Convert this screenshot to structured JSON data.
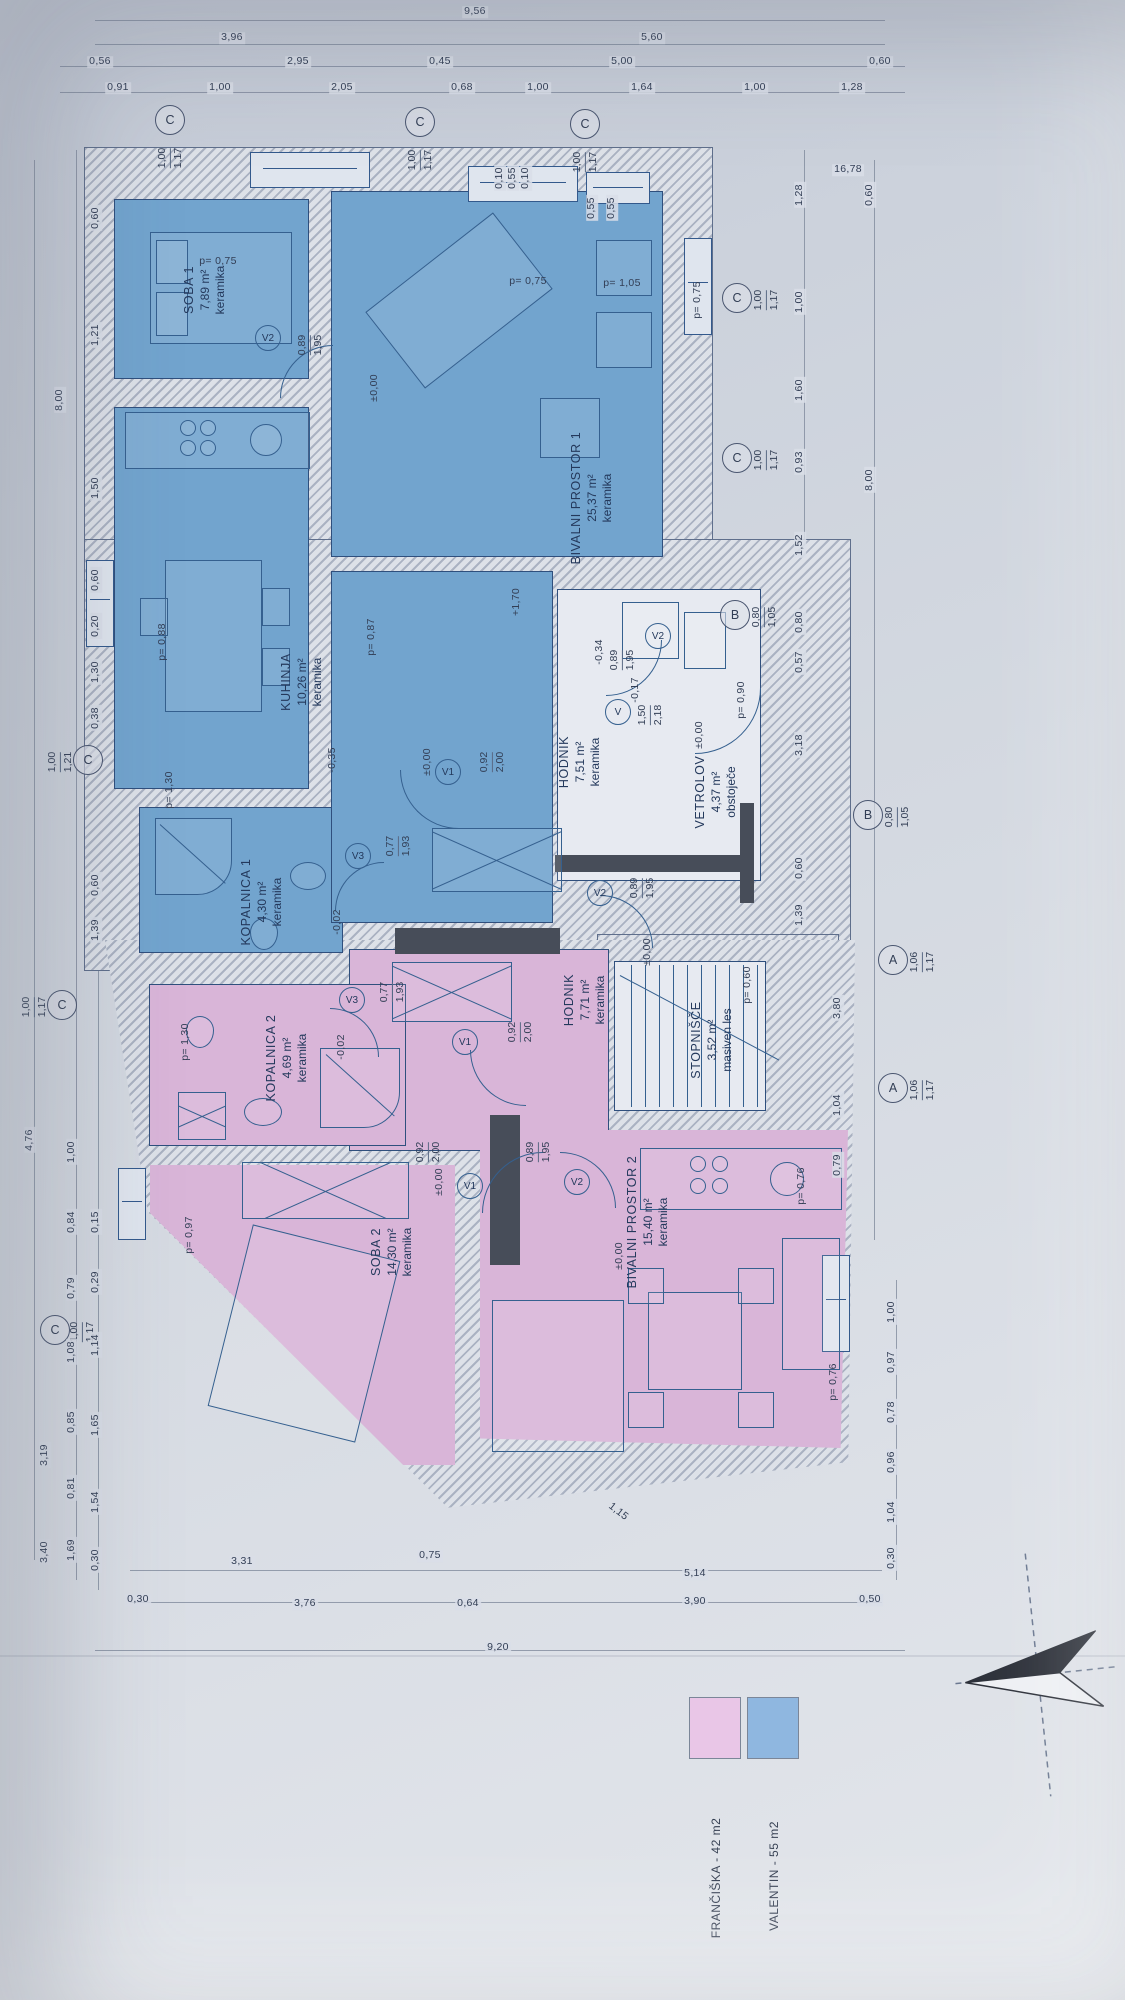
{
  "plan": {
    "type": "floor-plan",
    "orientation": "rotated-90",
    "apartment_colors": {
      "valentin": "#72a4ce",
      "franciska": "#d9b5d8"
    }
  },
  "legend": {
    "items": [
      {
        "label": "FRANČIŠKA - 42 m2",
        "color": "#e9c6e7",
        "x": 690,
        "y": 1698,
        "lx": 716,
        "ly": 1878
      },
      {
        "label": "VALENTIN - 55 m2",
        "color": "#8fb7e0",
        "x": 748,
        "y": 1698,
        "lx": 774,
        "ly": 1876
      }
    ]
  },
  "rooms": [
    {
      "name": "SOBA 1",
      "area": "7,89 m²",
      "finish": "keramika",
      "x": 205,
      "y": 290
    },
    {
      "name": "BIVALNI PROSTOR 1",
      "area": "25,37 m²",
      "finish": "keramika",
      "x": 592,
      "y": 498
    },
    {
      "name": "KUHINJA",
      "area": "10,26 m²",
      "finish": "keramika",
      "x": 302,
      "y": 682
    },
    {
      "name": "KOPALNICA 1",
      "area": "4,30 m²",
      "finish": "keramika",
      "x": 262,
      "y": 902
    },
    {
      "name": "HODNIK",
      "area": "7,51 m²",
      "finish": "keramika",
      "x": 580,
      "y": 762
    },
    {
      "name": "VETROLOV",
      "area": "4,37 m²",
      "finish": "obstoječe",
      "x": 716,
      "y": 792
    },
    {
      "name": "STOPNIŠČE",
      "area": "3,52 m²",
      "finish": "masiven les",
      "x": 712,
      "y": 1040
    },
    {
      "name": "HODNIK",
      "area": "7,71 m²",
      "finish": "keramika",
      "x": 585,
      "y": 1000
    },
    {
      "name": "KOPALNICA 2",
      "area": "4,69 m²",
      "finish": "keramika",
      "x": 287,
      "y": 1058
    },
    {
      "name": "SOBA 2",
      "area": "14,30 m²",
      "finish": "keramika",
      "x": 392,
      "y": 1252
    },
    {
      "name": "BIVALNI PROSTOR 2",
      "area": "15,40 m²",
      "finish": "keramika",
      "x": 648,
      "y": 1222
    }
  ],
  "door_tags": [
    {
      "label": "V2",
      "x": 268,
      "y": 338,
      "dims": [
        "0,89",
        "1,95"
      ],
      "dx": 310,
      "dy": 345
    },
    {
      "label": "V2",
      "x": 658,
      "y": 636,
      "dims": [
        "0,89",
        "1,95"
      ],
      "dx": 622,
      "dy": 660
    },
    {
      "label": "V1",
      "x": 448,
      "y": 772,
      "dims": [
        "0,92",
        "2,00"
      ],
      "dx": 492,
      "dy": 762
    },
    {
      "label": "V3",
      "x": 358,
      "y": 856,
      "dims": [
        "0,77",
        "1,93"
      ],
      "dx": 398,
      "dy": 846
    },
    {
      "label": "V2",
      "x": 600,
      "y": 893,
      "dims": [
        "0,89",
        "1,95"
      ],
      "dx": 642,
      "dy": 888
    },
    {
      "label": "V1",
      "x": 465,
      "y": 1042,
      "dims": [
        "0,92",
        "2,00"
      ],
      "dx": 520,
      "dy": 1032
    },
    {
      "label": "V3",
      "x": 352,
      "y": 1000,
      "dims": [
        "0,77",
        "1,93"
      ],
      "dx": 392,
      "dy": 992
    },
    {
      "label": "V1",
      "x": 470,
      "y": 1186,
      "dims": [
        "0,92",
        "2,00"
      ],
      "dx": 428,
      "dy": 1152
    },
    {
      "label": "V2",
      "x": 577,
      "y": 1182,
      "dims": [
        "0,89",
        "1,95"
      ],
      "dx": 538,
      "dy": 1152
    },
    {
      "label": "V",
      "x": 618,
      "y": 712,
      "dims": [
        "1,50",
        "2,18"
      ],
      "dx": 650,
      "dy": 715
    }
  ],
  "axis_markers": [
    {
      "label": "C",
      "x": 170,
      "y": 120,
      "dims": [
        "1,00",
        "1,17"
      ],
      "dx": 170,
      "dy": 158
    },
    {
      "label": "C",
      "x": 420,
      "y": 122,
      "dims": [
        "1,00",
        "1,17"
      ],
      "dx": 420,
      "dy": 160
    },
    {
      "label": "C",
      "x": 585,
      "y": 124,
      "dims": [
        "1,00",
        "1,17"
      ],
      "dx": 585,
      "dy": 162
    },
    {
      "label": "C",
      "x": 737,
      "y": 298,
      "dims": [
        "1,00",
        "1,17"
      ],
      "dx": 766,
      "dy": 300
    },
    {
      "label": "C",
      "x": 737,
      "y": 458,
      "dims": [
        "1,00",
        "1,17"
      ],
      "dx": 766,
      "dy": 460
    },
    {
      "label": "B",
      "x": 735,
      "y": 615,
      "dims": [
        "0,80",
        "1,05"
      ],
      "dx": 764,
      "dy": 617
    },
    {
      "label": "B",
      "x": 868,
      "y": 815,
      "dims": [
        "0,80",
        "1,05"
      ],
      "dx": 897,
      "dy": 817
    },
    {
      "label": "A",
      "x": 893,
      "y": 960,
      "dims": [
        "1,06",
        "1,17"
      ],
      "dx": 922,
      "dy": 962
    },
    {
      "label": "A",
      "x": 893,
      "y": 1088,
      "dims": [
        "1,06",
        "1,17"
      ],
      "dx": 922,
      "dy": 1090
    },
    {
      "label": "C",
      "x": 88,
      "y": 760,
      "dims": [
        "1,00",
        "1,21"
      ],
      "dx": 60,
      "dy": 762
    },
    {
      "label": "C",
      "x": 62,
      "y": 1005,
      "dims": [
        "1,00",
        "1,17"
      ],
      "dx": 34,
      "dy": 1007
    },
    {
      "label": "C",
      "x": 55,
      "y": 1330,
      "dims": [
        "1,00",
        "1,17"
      ],
      "dx": 82,
      "dy": 1332
    }
  ],
  "levels": [
    {
      "t": "±0,00",
      "x": 375,
      "y": 388
    },
    {
      "t": "±0,00",
      "x": 428,
      "y": 762
    },
    {
      "t": "±0,00",
      "x": 700,
      "y": 735
    },
    {
      "t": "±0,00",
      "x": 648,
      "y": 952
    },
    {
      "t": "±0,00",
      "x": 440,
      "y": 1182
    },
    {
      "t": "±0,00",
      "x": 620,
      "y": 1256
    },
    {
      "t": "+1,70",
      "x": 517,
      "y": 602
    },
    {
      "t": "-0,35",
      "x": 333,
      "y": 760
    },
    {
      "t": "-0,02",
      "x": 338,
      "y": 922
    },
    {
      "t": "-0,02",
      "x": 342,
      "y": 1047
    },
    {
      "t": "-0,34",
      "x": 600,
      "y": 652
    },
    {
      "t": "-0,17",
      "x": 636,
      "y": 690
    }
  ],
  "parapets": [
    {
      "t": "p= 0,75",
      "x": 218,
      "y": 262,
      "o": "h"
    },
    {
      "t": "p= 0,75",
      "x": 528,
      "y": 282,
      "o": "h"
    },
    {
      "t": "p= 1,05",
      "x": 622,
      "y": 284,
      "o": "h"
    },
    {
      "t": "p= 0,75",
      "x": 698,
      "y": 300,
      "o": "v"
    },
    {
      "t": "p= 0,88",
      "x": 163,
      "y": 642,
      "o": "v"
    },
    {
      "t": "p= 0,87",
      "x": 372,
      "y": 637,
      "o": "v"
    },
    {
      "t": "p= 1,30",
      "x": 170,
      "y": 790,
      "o": "v"
    },
    {
      "t": "p= 1,30",
      "x": 186,
      "y": 1042,
      "o": "v"
    },
    {
      "t": "p= 0,90",
      "x": 742,
      "y": 700,
      "o": "v"
    },
    {
      "t": "p= 0,60",
      "x": 748,
      "y": 985,
      "o": "v"
    },
    {
      "t": "p= 0,97",
      "x": 190,
      "y": 1235,
      "o": "v"
    },
    {
      "t": "p= 0,76",
      "x": 802,
      "y": 1186,
      "o": "v"
    },
    {
      "t": "p= 0,76",
      "x": 834,
      "y": 1382,
      "o": "v"
    }
  ],
  "dims": [
    {
      "t": "9,56",
      "x": 475,
      "y": 12,
      "o": "h"
    },
    {
      "t": "3,96",
      "x": 232,
      "y": 38,
      "o": "h"
    },
    {
      "t": "5,60",
      "x": 652,
      "y": 38,
      "o": "h"
    },
    {
      "t": "0,56",
      "x": 100,
      "y": 62,
      "o": "h"
    },
    {
      "t": "2,95",
      "x": 298,
      "y": 62,
      "o": "h"
    },
    {
      "t": "0,45",
      "x": 440,
      "y": 62,
      "o": "h"
    },
    {
      "t": "5,00",
      "x": 622,
      "y": 62,
      "o": "h"
    },
    {
      "t": "0,60",
      "x": 880,
      "y": 62,
      "o": "h"
    },
    {
      "t": "0,91",
      "x": 118,
      "y": 88,
      "o": "h"
    },
    {
      "t": "1,00",
      "x": 220,
      "y": 88,
      "o": "h"
    },
    {
      "t": "2,05",
      "x": 342,
      "y": 88,
      "o": "h"
    },
    {
      "t": "0,68",
      "x": 462,
      "y": 88,
      "o": "h"
    },
    {
      "t": "1,00",
      "x": 538,
      "y": 88,
      "o": "h"
    },
    {
      "t": "1,64",
      "x": 642,
      "y": 88,
      "o": "h"
    },
    {
      "t": "1,00",
      "x": 755,
      "y": 88,
      "o": "h"
    },
    {
      "t": "1,28",
      "x": 852,
      "y": 88,
      "o": "h"
    },
    {
      "t": "16,78",
      "x": 848,
      "y": 170,
      "o": "h"
    },
    {
      "t": "0,10",
      "x": 500,
      "y": 178,
      "o": "v"
    },
    {
      "t": "0,55",
      "x": 513,
      "y": 178,
      "o": "v"
    },
    {
      "t": "0,10",
      "x": 526,
      "y": 178,
      "o": "v"
    },
    {
      "t": "0,55",
      "x": 592,
      "y": 208,
      "o": "v"
    },
    {
      "t": "0,55",
      "x": 612,
      "y": 208,
      "o": "v"
    },
    {
      "t": "0,60",
      "x": 96,
      "y": 218,
      "o": "v"
    },
    {
      "t": "1,21",
      "x": 96,
      "y": 335,
      "o": "v"
    },
    {
      "t": "1,50",
      "x": 96,
      "y": 488,
      "o": "v"
    },
    {
      "t": "0,60",
      "x": 96,
      "y": 580,
      "o": "v"
    },
    {
      "t": "0,20",
      "x": 96,
      "y": 626,
      "o": "v"
    },
    {
      "t": "1,30",
      "x": 96,
      "y": 672,
      "o": "v"
    },
    {
      "t": "0,38",
      "x": 96,
      "y": 718,
      "o": "v"
    },
    {
      "t": "0,60",
      "x": 96,
      "y": 885,
      "o": "v"
    },
    {
      "t": "1,39",
      "x": 96,
      "y": 930,
      "o": "v"
    },
    {
      "t": "8,00",
      "x": 60,
      "y": 400,
      "o": "v"
    },
    {
      "t": "1,28",
      "x": 800,
      "y": 195,
      "o": "v"
    },
    {
      "t": "1,00",
      "x": 800,
      "y": 302,
      "o": "v"
    },
    {
      "t": "1,60",
      "x": 800,
      "y": 390,
      "o": "v"
    },
    {
      "t": "0,93",
      "x": 800,
      "y": 462,
      "o": "v"
    },
    {
      "t": "1,52",
      "x": 800,
      "y": 545,
      "o": "v"
    },
    {
      "t": "0,80",
      "x": 800,
      "y": 622,
      "o": "v"
    },
    {
      "t": "0,57",
      "x": 800,
      "y": 662,
      "o": "v"
    },
    {
      "t": "3,18",
      "x": 800,
      "y": 745,
      "o": "v"
    },
    {
      "t": "0,60",
      "x": 800,
      "y": 868,
      "o": "v"
    },
    {
      "t": "1,39",
      "x": 800,
      "y": 915,
      "o": "v"
    },
    {
      "t": "3,80",
      "x": 838,
      "y": 1008,
      "o": "v"
    },
    {
      "t": "1,04",
      "x": 838,
      "y": 1105,
      "o": "v"
    },
    {
      "t": "0,79",
      "x": 838,
      "y": 1165,
      "o": "v"
    },
    {
      "t": "0,60",
      "x": 870,
      "y": 195,
      "o": "v"
    },
    {
      "t": "8,00",
      "x": 870,
      "y": 480,
      "o": "v"
    },
    {
      "t": "1,00",
      "x": 892,
      "y": 1312,
      "o": "v"
    },
    {
      "t": "0,97",
      "x": 892,
      "y": 1362,
      "o": "v"
    },
    {
      "t": "0,78",
      "x": 892,
      "y": 1412,
      "o": "v"
    },
    {
      "t": "0,96",
      "x": 892,
      "y": 1462,
      "o": "v"
    },
    {
      "t": "1,04",
      "x": 892,
      "y": 1512,
      "o": "v"
    },
    {
      "t": "0,30",
      "x": 892,
      "y": 1558,
      "o": "v"
    },
    {
      "t": "4,76",
      "x": 30,
      "y": 1140,
      "o": "v"
    },
    {
      "t": "1,00",
      "x": 72,
      "y": 1152,
      "o": "v"
    },
    {
      "t": "0,84",
      "x": 72,
      "y": 1222,
      "o": "v"
    },
    {
      "t": "0,79",
      "x": 72,
      "y": 1288,
      "o": "v"
    },
    {
      "t": "1,08",
      "x": 72,
      "y": 1352,
      "o": "v"
    },
    {
      "t": "0,85",
      "x": 72,
      "y": 1422,
      "o": "v"
    },
    {
      "t": "0,81",
      "x": 72,
      "y": 1488,
      "o": "v"
    },
    {
      "t": "1,69",
      "x": 72,
      "y": 1550,
      "o": "v"
    },
    {
      "t": "0,15",
      "x": 96,
      "y": 1222,
      "o": "v"
    },
    {
      "t": "0,29",
      "x": 96,
      "y": 1282,
      "o": "v"
    },
    {
      "t": "1,14",
      "x": 96,
      "y": 1345,
      "o": "v"
    },
    {
      "t": "1,65",
      "x": 96,
      "y": 1425,
      "o": "v"
    },
    {
      "t": "1,54",
      "x": 96,
      "y": 1502,
      "o": "v"
    },
    {
      "t": "0,30",
      "x": 96,
      "y": 1560,
      "o": "v"
    },
    {
      "t": "3,19",
      "x": 45,
      "y": 1455,
      "o": "v"
    },
    {
      "t": "3,40",
      "x": 45,
      "y": 1552,
      "o": "v"
    },
    {
      "t": "1,15",
      "x": 618,
      "y": 1512,
      "o": "d"
    },
    {
      "t": "3,31",
      "x": 242,
      "y": 1562,
      "o": "h"
    },
    {
      "t": "0,75",
      "x": 430,
      "y": 1556,
      "o": "h"
    },
    {
      "t": "5,14",
      "x": 695,
      "y": 1574,
      "o": "h"
    },
    {
      "t": "3,90",
      "x": 695,
      "y": 1602,
      "o": "h"
    },
    {
      "t": "0,50",
      "x": 870,
      "y": 1600,
      "o": "h"
    },
    {
      "t": "0,30",
      "x": 138,
      "y": 1600,
      "o": "h"
    },
    {
      "t": "3,76",
      "x": 305,
      "y": 1604,
      "o": "h"
    },
    {
      "t": "0,64",
      "x": 468,
      "y": 1604,
      "o": "h"
    },
    {
      "t": "9,20",
      "x": 498,
      "y": 1648,
      "o": "h"
    }
  ]
}
